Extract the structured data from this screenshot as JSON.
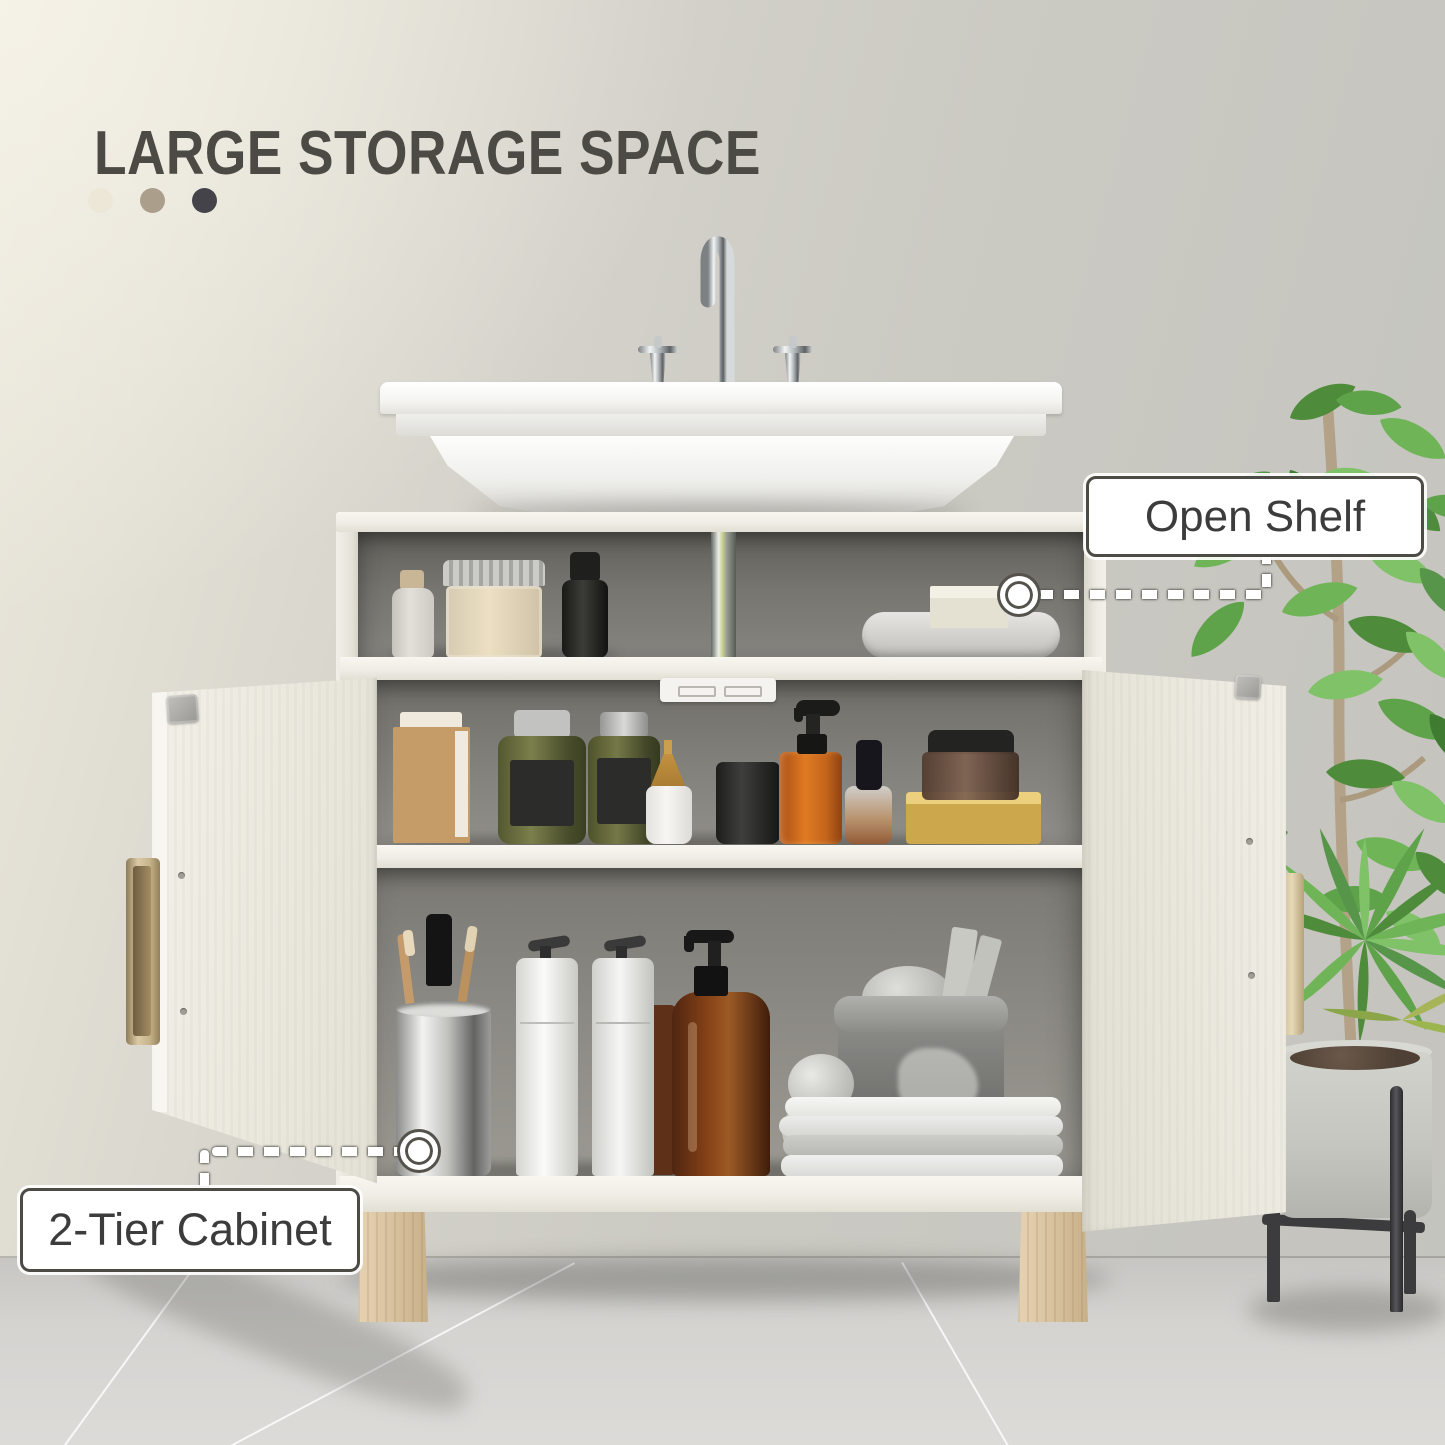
{
  "page": {
    "title": "LARGE STORAGE SPACE"
  },
  "color_swatches": {
    "items": [
      {
        "name": "cream",
        "hex": "#ece7d6"
      },
      {
        "name": "tan",
        "hex": "#ab9f8c"
      },
      {
        "name": "charcoal",
        "hex": "#45434a"
      }
    ]
  },
  "callouts": {
    "open_shelf": {
      "label": "Open Shelf"
    },
    "two_tier_cabinet": {
      "label": "2-Tier Cabinet"
    }
  },
  "palette": {
    "wall": "#cac9c2",
    "wall_warm_light": "#ece8dc",
    "floor": "#d6d5d2",
    "cabinet_white": "#f0eee6",
    "interior_gray": "#7c7a75",
    "wood_leg": "#d9c3a0",
    "brass_handle": "#cdb88f",
    "plant_green": "#5d9c49",
    "pot_concrete": "#c8c8c3",
    "title_text": "#4b4a45",
    "callout_border": "#4d4b45",
    "callout_text": "#3c3c3c"
  }
}
